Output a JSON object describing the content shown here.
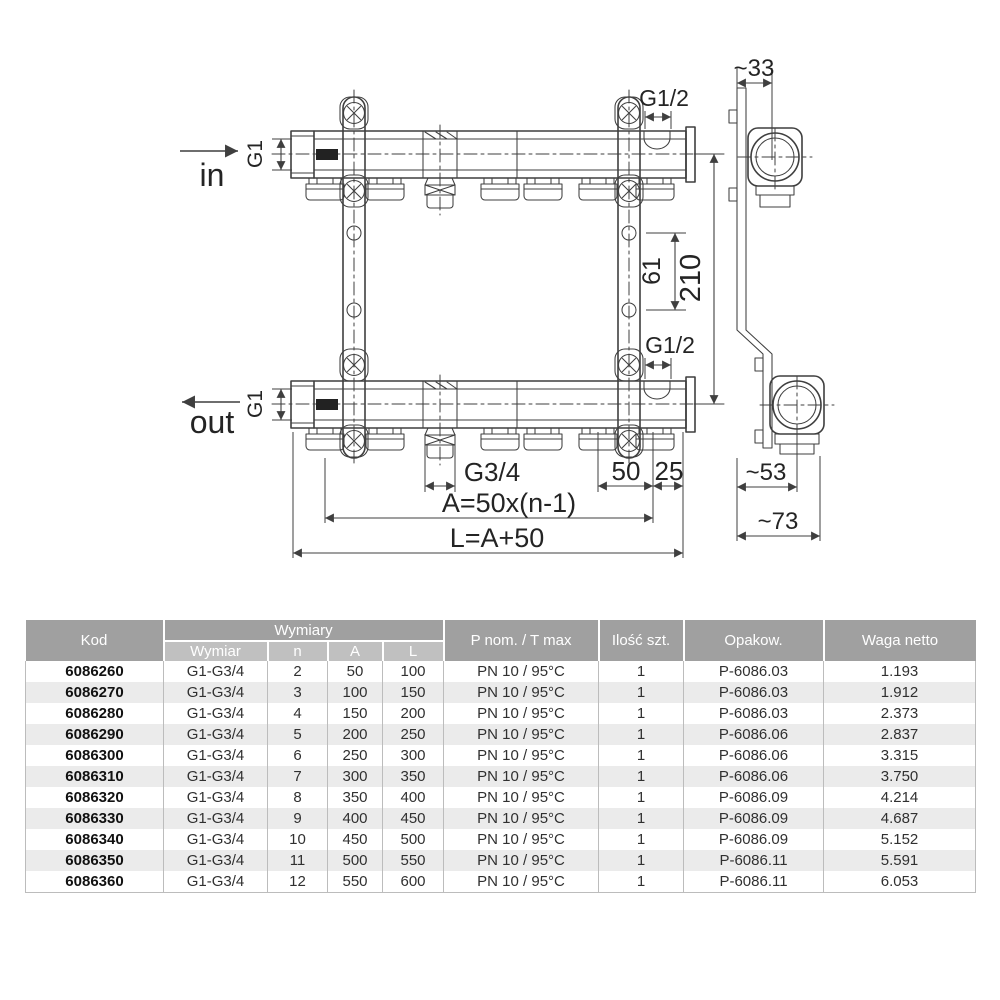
{
  "drawing": {
    "flow_in": "in",
    "flow_out": "out",
    "thread_main_top": "G1",
    "thread_main_bottom": "G1",
    "thread_fill_top": "G1/2",
    "thread_fill_bottom": "G1/2",
    "thread_outlet": "G3/4",
    "dim_bracket_depth": "~33",
    "dim_hole_spacing": "61",
    "dim_axis_height": "210",
    "dim_outlet_pitch": "50",
    "dim_end_offset": "25",
    "dim_depth_body": "~53",
    "dim_depth_total": "~73",
    "dim_a_formula": "A=50x(n-1)",
    "dim_l_formula": "L=A+50"
  },
  "table": {
    "headers": {
      "kod": "Kod",
      "wymiary_group": "Wymiary",
      "wymiar": "Wymiar",
      "n": "n",
      "a": "A",
      "l": "L",
      "p_nom": "P nom. / T max",
      "ilosc": "Ilość szt.",
      "opakow": "Opakow.",
      "waga": "Waga netto"
    },
    "rows": [
      {
        "kod": "6086260",
        "wymiar": "G1-G3/4",
        "n": "2",
        "a": "50",
        "l": "100",
        "p_nom": "PN 10 / 95°C",
        "ilosc": "1",
        "opakow": "P-6086.03",
        "waga": "1.193"
      },
      {
        "kod": "6086270",
        "wymiar": "G1-G3/4",
        "n": "3",
        "a": "100",
        "l": "150",
        "p_nom": "PN 10 / 95°C",
        "ilosc": "1",
        "opakow": "P-6086.03",
        "waga": "1.912"
      },
      {
        "kod": "6086280",
        "wymiar": "G1-G3/4",
        "n": "4",
        "a": "150",
        "l": "200",
        "p_nom": "PN 10 / 95°C",
        "ilosc": "1",
        "opakow": "P-6086.03",
        "waga": "2.373"
      },
      {
        "kod": "6086290",
        "wymiar": "G1-G3/4",
        "n": "5",
        "a": "200",
        "l": "250",
        "p_nom": "PN 10 / 95°C",
        "ilosc": "1",
        "opakow": "P-6086.06",
        "waga": "2.837"
      },
      {
        "kod": "6086300",
        "wymiar": "G1-G3/4",
        "n": "6",
        "a": "250",
        "l": "300",
        "p_nom": "PN 10 / 95°C",
        "ilosc": "1",
        "opakow": "P-6086.06",
        "waga": "3.315"
      },
      {
        "kod": "6086310",
        "wymiar": "G1-G3/4",
        "n": "7",
        "a": "300",
        "l": "350",
        "p_nom": "PN 10 / 95°C",
        "ilosc": "1",
        "opakow": "P-6086.06",
        "waga": "3.750"
      },
      {
        "kod": "6086320",
        "wymiar": "G1-G3/4",
        "n": "8",
        "a": "350",
        "l": "400",
        "p_nom": "PN 10 / 95°C",
        "ilosc": "1",
        "opakow": "P-6086.09",
        "waga": "4.214"
      },
      {
        "kod": "6086330",
        "wymiar": "G1-G3/4",
        "n": "9",
        "a": "400",
        "l": "450",
        "p_nom": "PN 10 / 95°C",
        "ilosc": "1",
        "opakow": "P-6086.09",
        "waga": "4.687"
      },
      {
        "kod": "6086340",
        "wymiar": "G1-G3/4",
        "n": "10",
        "a": "450",
        "l": "500",
        "p_nom": "PN 10 / 95°C",
        "ilosc": "1",
        "opakow": "P-6086.09",
        "waga": "5.152"
      },
      {
        "kod": "6086350",
        "wymiar": "G1-G3/4",
        "n": "11",
        "a": "500",
        "l": "550",
        "p_nom": "PN 10 / 95°C",
        "ilosc": "1",
        "opakow": "P-6086.11",
        "waga": "5.591"
      },
      {
        "kod": "6086360",
        "wymiar": "G1-G3/4",
        "n": "12",
        "a": "550",
        "l": "600",
        "p_nom": "PN 10 / 95°C",
        "ilosc": "1",
        "opakow": "P-6086.11",
        "waga": "6.053"
      }
    ]
  },
  "colors": {
    "header_dark": "#a0a0a0",
    "header_light": "#c0c0c0",
    "row_alt": "#ebebeb",
    "line": "#3f3f3f"
  }
}
